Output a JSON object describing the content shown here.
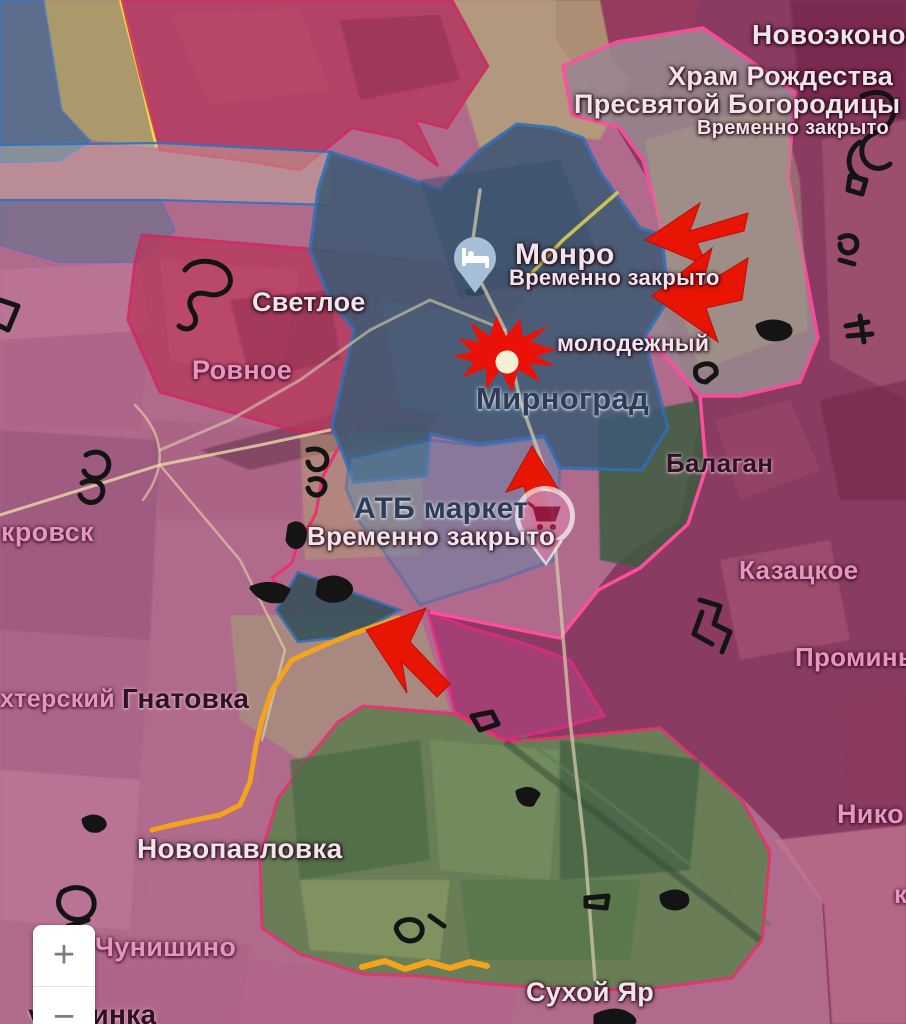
{
  "pois": {
    "hram": {
      "title_line1": "Храм Рождества",
      "title_line2": "Пресвятой Богородицы",
      "subtitle": "Временно закрыто"
    },
    "monro": {
      "title": "Монро",
      "subtitle": "Временно закрыто",
      "icon": "bed-icon"
    },
    "atb": {
      "title": "АТБ маркет",
      "subtitle": "Временно закрыто",
      "icon": "shopping-cart-icon"
    }
  },
  "places": {
    "novoekonom": "Новоэконом",
    "svetloe": "Светлое",
    "rovnoe": "Ровное",
    "molodezhny": "молодежный",
    "mirnograd": "Мирноград",
    "balagan": "Балаган",
    "pokrovsk_partial": "кровск",
    "kazatskoe": "Казацкое",
    "promin_partial": "Проминь",
    "shakhtersky_partial": "хтерский",
    "gnatovka": "Гнатовка",
    "nikolaevka_partial": "Нико",
    "k_partial": "к",
    "novopavlovka": "Новопавловка",
    "chunishino": "Чунишино",
    "sukhoy_yar": "Сухой Яр",
    "ukrainka_partial": "украинка"
  },
  "zoom_controls": {
    "zoom_in_label": "+",
    "zoom_out_label": "−"
  },
  "icons": {
    "hotel_marker": "bed-icon",
    "shop_marker": "shopping-cart-icon",
    "zoom_in": "plus-icon",
    "zoom_out": "minus-icon"
  },
  "colors": {
    "occupied_fill": "#84325a",
    "advance_gray_fill": "#99878e",
    "frontline_pink": "#ff4da0",
    "frontline_crimson": "#d2205a",
    "contested_blue_outline": "#2e6fb5",
    "city_zone_fill": "#3e5a73",
    "frontline_orange": "#f5a31d",
    "frontline_yellow": "#ebe545",
    "attack_arrow_red": "#e81505",
    "explosion_red": "#ea1208",
    "fortification_black": "#141414"
  }
}
